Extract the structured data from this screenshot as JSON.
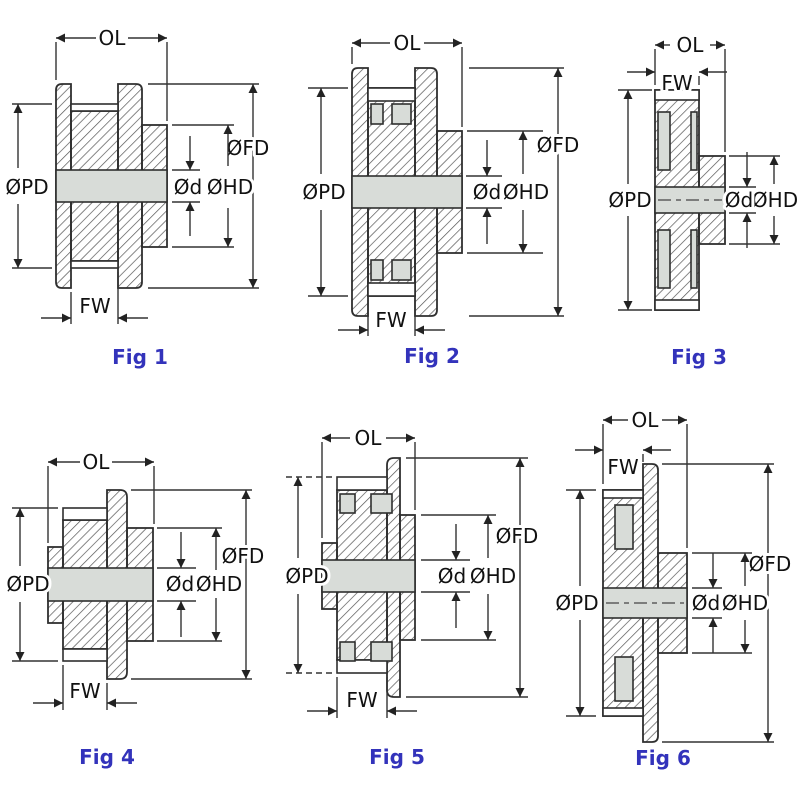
{
  "colors": {
    "background": "#ffffff",
    "outline": "#2f2f2f",
    "hatch_line": "#555555",
    "dimension_line": "#333333",
    "section_gray": "#d8dcd8",
    "surface_white": "#ffffff",
    "caption_blue": "#3333bb",
    "label_text": "#111111"
  },
  "figures": [
    {
      "caption": "Fig 1",
      "labels": {
        "ol": "OL",
        "fw": "FW",
        "pd": "ØPD",
        "fd": "ØFD",
        "hd": "ØHD",
        "d": "Ød"
      }
    },
    {
      "caption": "Fig 2",
      "labels": {
        "ol": "OL",
        "fw": "FW",
        "pd": "ØPD",
        "fd": "ØFD",
        "hd": "ØHD",
        "d": "Ød"
      }
    },
    {
      "caption": "Fig 3",
      "labels": {
        "ol": "OL",
        "fw": "FW",
        "pd": "ØPD",
        "fd": "ØFD",
        "hd": "ØHD",
        "d": "Ød"
      }
    },
    {
      "caption": "Fig 4",
      "labels": {
        "ol": "OL",
        "fw": "FW",
        "pd": "ØPD",
        "fd": "ØFD",
        "hd": "ØHD",
        "d": "Ød"
      }
    },
    {
      "caption": "Fig 5",
      "labels": {
        "ol": "OL",
        "fw": "FW",
        "pd": "ØPD",
        "fd": "ØFD",
        "hd": "ØHD",
        "d": "Ød"
      }
    },
    {
      "caption": "Fig 6",
      "labels": {
        "ol": "OL",
        "fw": "FW",
        "pd": "ØPD",
        "fd": "ØFD",
        "hd": "ØHD",
        "d": "Ød"
      }
    }
  ]
}
